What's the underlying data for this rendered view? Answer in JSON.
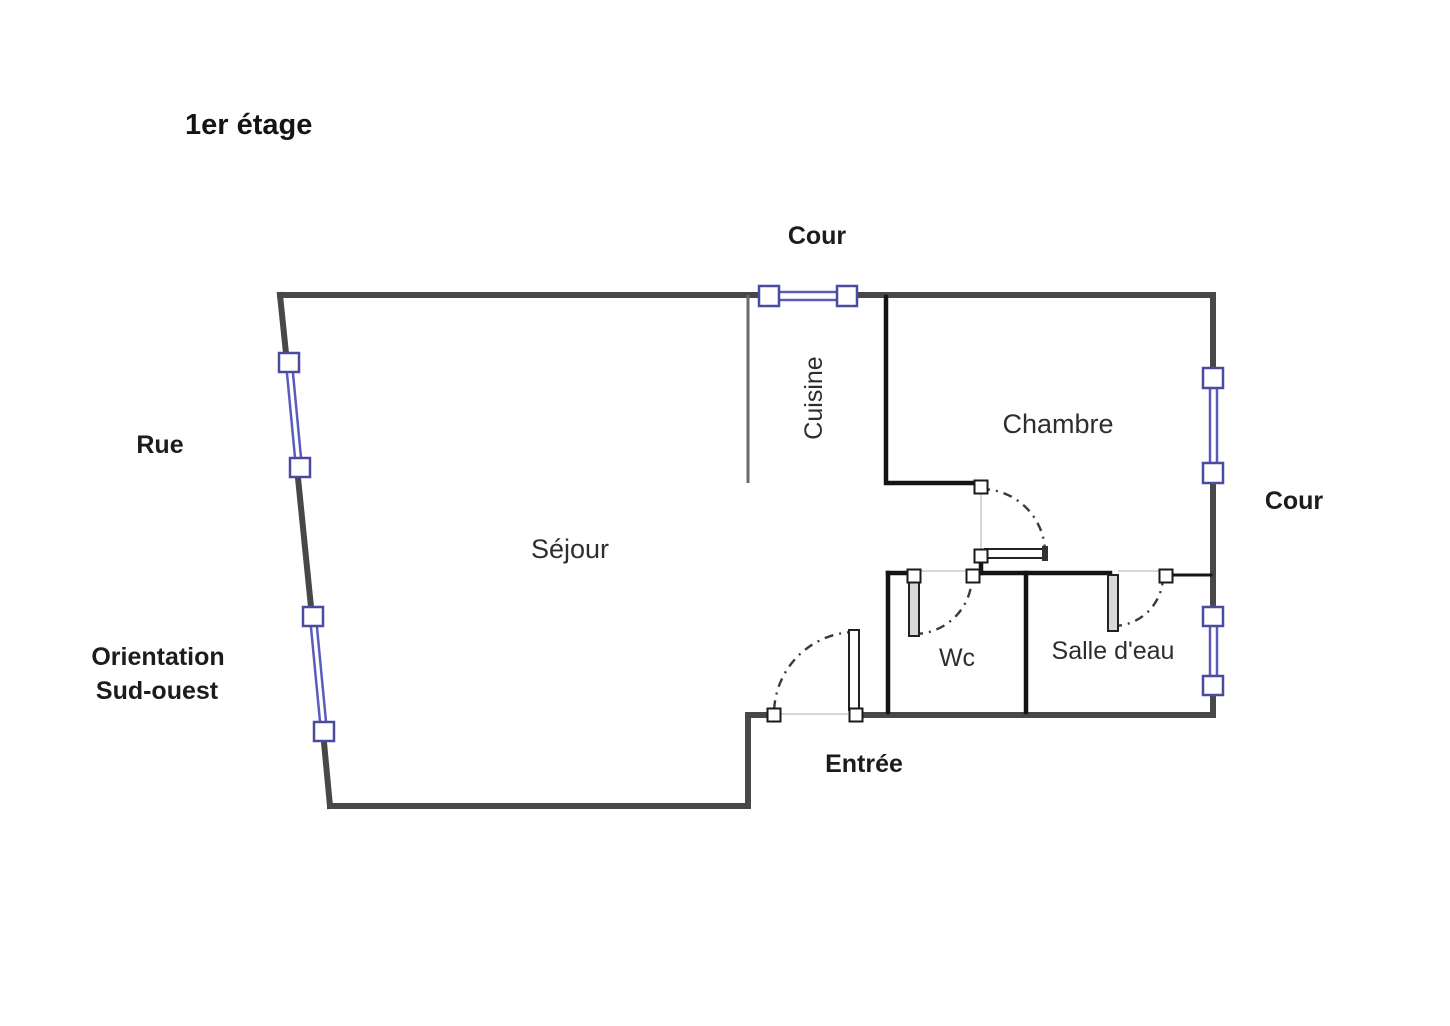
{
  "title": "1er étage",
  "floor_plan": {
    "rooms": {
      "sejour": "Séjour",
      "cuisine": "Cuisine",
      "chambre": "Chambre",
      "wc": "Wc",
      "salle_deau": "Salle d'eau"
    },
    "exterior_labels": {
      "cour_top": "Cour",
      "cour_right": "Cour",
      "rue": "Rue",
      "orientation_line1": "Orientation",
      "orientation_line2": "Sud-ouest",
      "entree": "Entrée"
    },
    "colors": {
      "exterior_wall": "#484848",
      "interior_wall": "#141414",
      "window_frame": "#4a4a9e",
      "window_glass": "#5b5bbf",
      "door_arc": "#3a3a3a"
    }
  }
}
